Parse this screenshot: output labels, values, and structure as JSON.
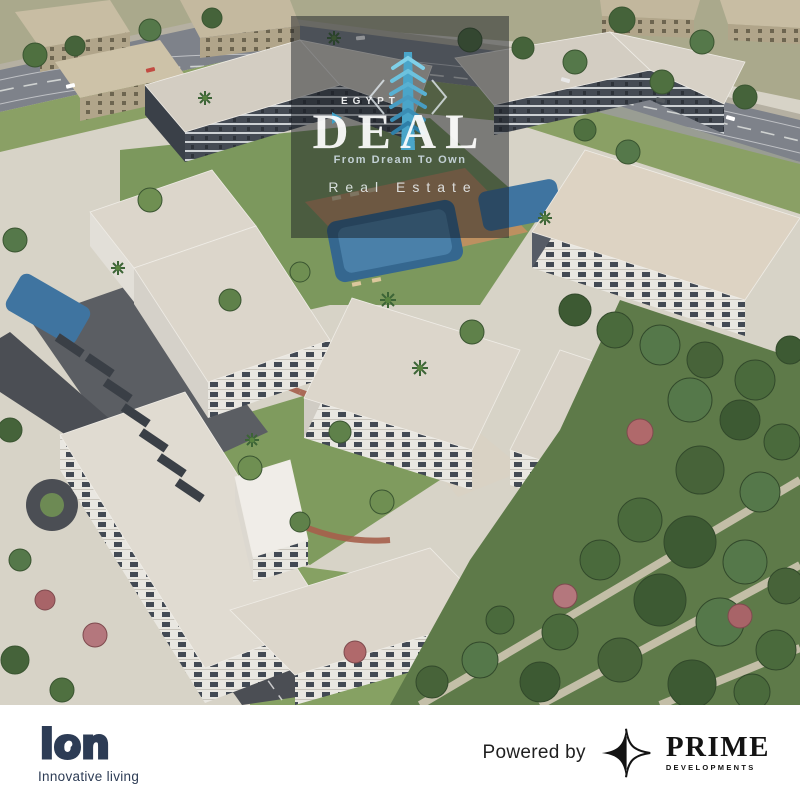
{
  "meta": {
    "description": "Aerial 3D architectural render of a white residential apartment compound with pools, courtyards, a highway at top and dense trees on the right; marketing image with watermark and developer logos"
  },
  "watermark": {
    "brand_top": "EGYPT",
    "brand_main": "DEAL",
    "tagline": "From Dream To Own",
    "subtitle": "Real Estate",
    "overlay_color": "rgba(24,28,34,0.48)",
    "tower_color_top": "#7fd0e8",
    "tower_color_bottom": "#2e7fa8",
    "icons": [
      "egypt-deal-tower-icon",
      "chevron-left-icon",
      "chevron-right-icon",
      "play-arrow-icon"
    ]
  },
  "footer": {
    "ion": {
      "wordmark": "ion",
      "tagline": "Innovative living",
      "color": "#2d3c55"
    },
    "powered_by_label": "Powered by",
    "prime": {
      "name": "PRIME",
      "subtitle": "DEVELOPMENTS",
      "color": "#131313",
      "icon": "prime-star-icon"
    }
  },
  "scene": {
    "palette": {
      "roof_light": "#dcd6cb",
      "roof_beige": "#ddd3c3",
      "facade_dark": "#454b54",
      "facade_light": "#e9e7e1",
      "pool_blue": "#3b6e9c",
      "lawn_green": "#7c985d",
      "forest_green": "#4c6a3d",
      "asphalt_dark": "#4b4e54",
      "highway_gray": "#7e828a",
      "path_red": "#a65f4b",
      "deck_wood": "#bd9060"
    }
  }
}
